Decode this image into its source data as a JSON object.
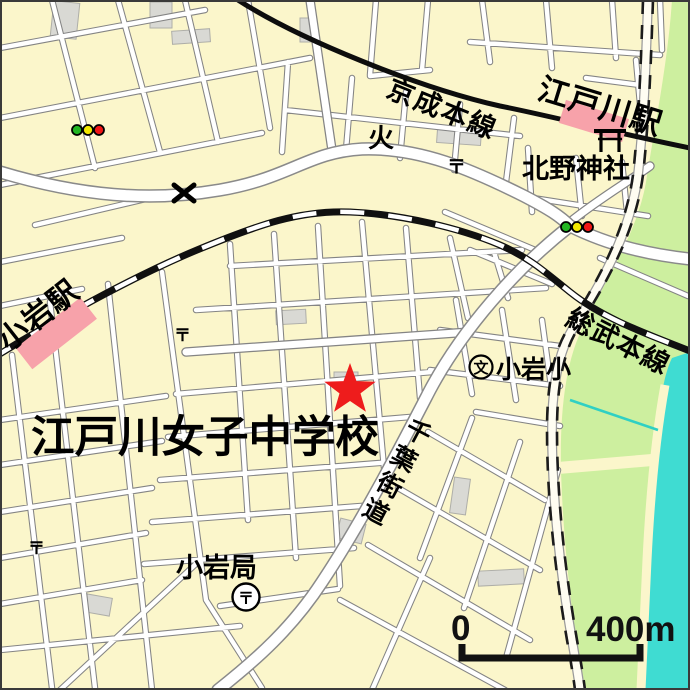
{
  "map": {
    "marker": {
      "label": "江戸川女子中学校",
      "symbol": "star",
      "color": "#ee1c1c"
    },
    "railways": {
      "keisei": "京成本線",
      "sobu": "総武本線"
    },
    "stations": {
      "edogawa": "江戸川駅",
      "koiwa": "小岩駅"
    },
    "pois": {
      "kitano_shrine": "北野神社",
      "koiwa_elementary": "小岩小",
      "koiwa_post_office": "小岩局"
    },
    "road_names": {
      "chiba_kaido": [
        "千",
        "葉",
        "街",
        "道"
      ]
    },
    "symbols": {
      "postal": "〒",
      "fire_station": "火",
      "school": "文",
      "police_box": "✕"
    },
    "scale_bar": {
      "start": "0",
      "end": "400m"
    },
    "colors": {
      "background": "#fbf6cb",
      "road_fill": "#ffffff",
      "road_casing": "#848484",
      "railway": "#101010",
      "station_box": "#f7a2aa",
      "greenbelt": "#cdef9f",
      "river": "#3fdcd2",
      "marker_star": "#ee1c1c",
      "signal_green": "#22b522",
      "signal_yellow": "#f2e800",
      "signal_red": "#f01616"
    }
  }
}
